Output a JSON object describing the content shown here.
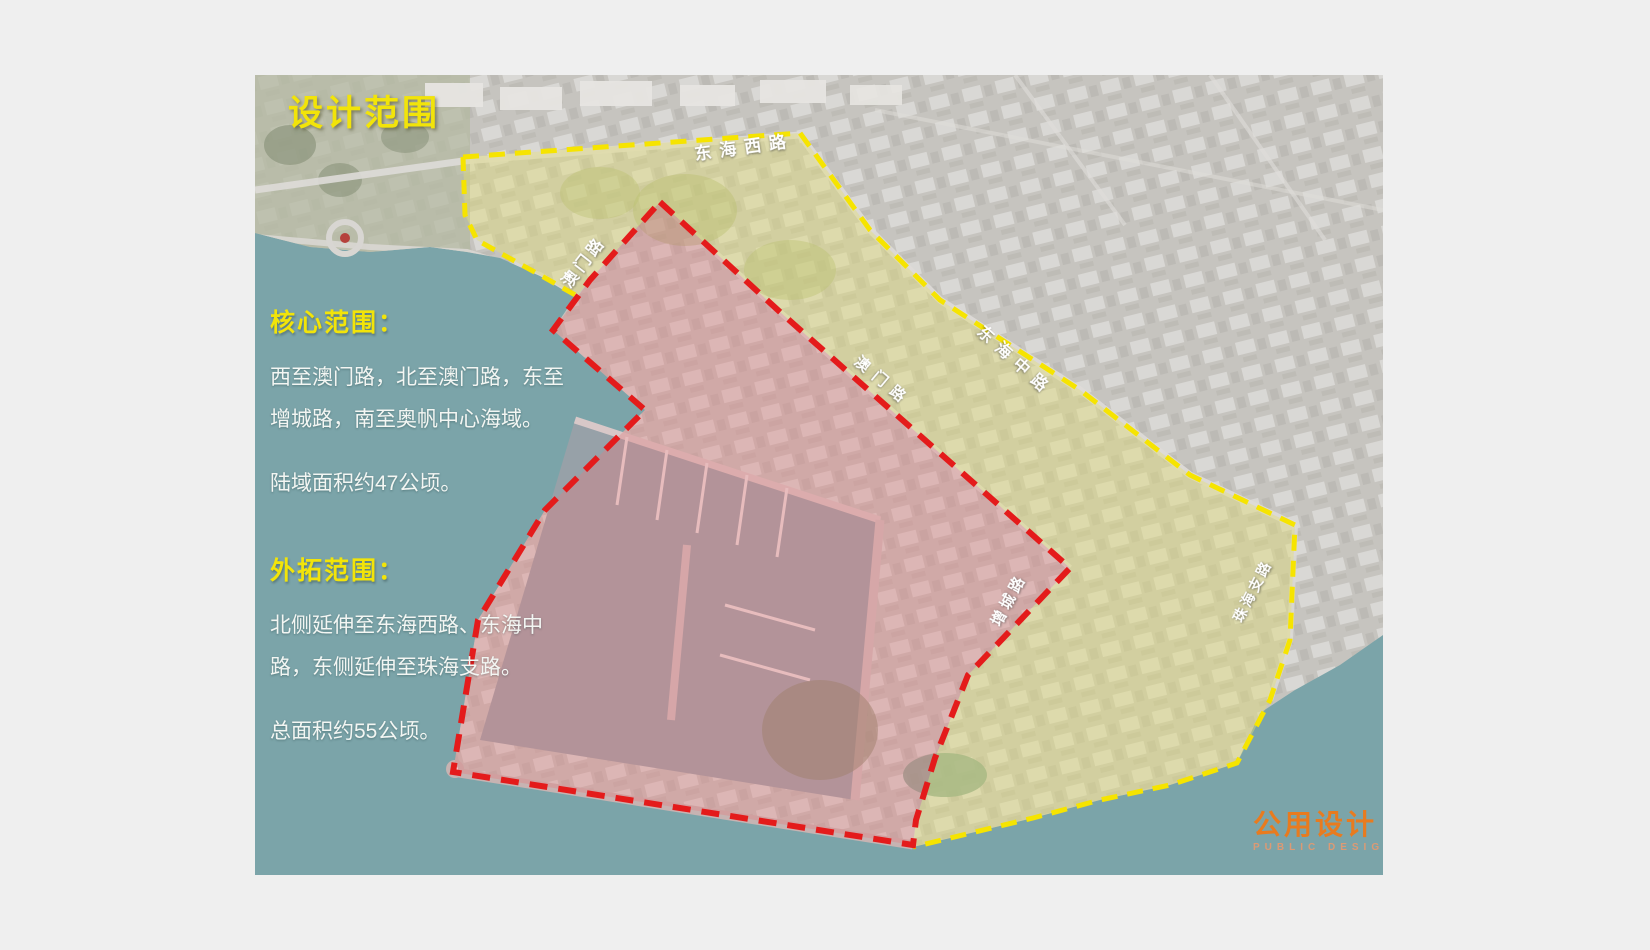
{
  "title": "设计范围",
  "panel": {
    "core": {
      "heading": "核心范围：",
      "lines": [
        "西至澳门路，北至澳门路，东至",
        "增城路，南至奥帆中心海域。"
      ],
      "area": "陆域面积约47公顷。"
    },
    "extended": {
      "heading": "外拓范围：",
      "lines": [
        "北侧延伸至东海西路、东海中",
        "路，东侧延伸至珠海支路。"
      ],
      "area": "总面积约55公顷。"
    }
  },
  "map_labels": {
    "donghai_west_road": "东海西路",
    "aomen_road_nw": "澳门路",
    "aomen_road_mid": "澳门路",
    "donghai_mid_road": "东海中路",
    "zengcheng_road": "增城路",
    "zhuhai_branch_road": "珠海支路"
  },
  "logo": {
    "cn": "公用设计",
    "en": "PUBLIC DESIGN"
  },
  "legend_semantics": {
    "red_dashed_boundary": "核心范围边界",
    "yellow_dashed_boundary": "外拓范围边界"
  },
  "colors": {
    "background": "#efefef",
    "sea": "#7ba4a9",
    "land": "#c6c4bf",
    "core_boundary": "#e41b1b",
    "core_fill": "rgba(225,125,130,0.38)",
    "extended_boundary": "#f6e400",
    "extended_fill": "rgba(226,222,116,0.42)",
    "title_yellow": "#f2e409",
    "logo_orange": "#e87b1f"
  }
}
